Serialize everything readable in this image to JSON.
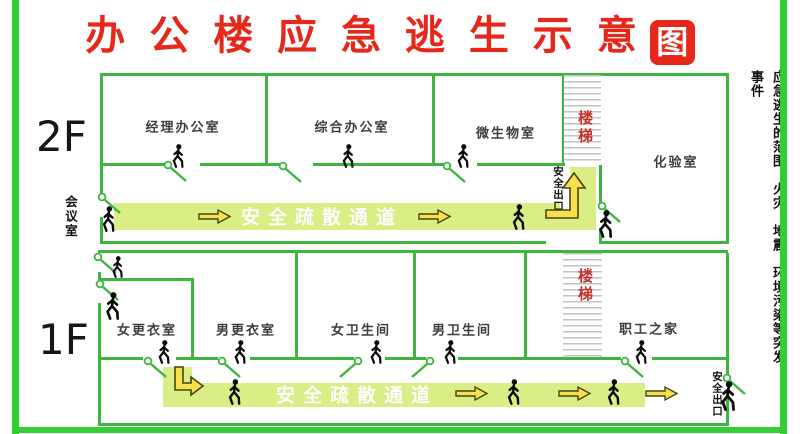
{
  "title": {
    "main": "办 公 楼 应 急 逃 生 示 意",
    "boxed": "图"
  },
  "side_note": "应急逃生的范围：火灾、地震、环境污染等突发事件",
  "floors": {
    "f2": "2F",
    "f1": "1F"
  },
  "labels": {
    "stairs": "楼梯",
    "corridor": "安全疏散通道",
    "exit": "安全出口",
    "meeting_room": "会议室"
  },
  "rooms_f2": [
    {
      "name": "经理办公室",
      "cx": 183,
      "cy": 126
    },
    {
      "name": "综合办公室",
      "cx": 352,
      "cy": 126
    },
    {
      "name": "微生物室",
      "cx": 506,
      "cy": 132
    },
    {
      "name": "化验室",
      "cx": 676,
      "cy": 161
    }
  ],
  "rooms_f1": [
    {
      "name": "女更衣室",
      "cx": 147,
      "cy": 329
    },
    {
      "name": "男更衣室",
      "cx": 246,
      "cy": 329
    },
    {
      "name": "女卫生间",
      "cx": 361,
      "cy": 329
    },
    {
      "name": "男卫生间",
      "cx": 462,
      "cy": 329
    },
    {
      "name": "职工之家",
      "cx": 649,
      "cy": 328
    }
  ],
  "colors": {
    "frame_green": "#35cd35",
    "wall_green": "#3eb53e",
    "band_green": "#d9ee85",
    "title_red": "#e6281b",
    "stairs_red": "#c5312a",
    "arrow_yellow": "#f7e04e",
    "hatch_gray": "#c3c3c3"
  },
  "geometry": {
    "canvas": {
      "w": 800,
      "h": 434
    },
    "frame": [
      [
        12,
        0,
        7,
        434
      ],
      [
        780,
        0,
        7,
        434
      ],
      [
        12,
        427,
        775,
        6
      ]
    ],
    "walls": [
      [
        100,
        73,
        629,
        3
      ],
      [
        100,
        73,
        3,
        125
      ],
      [
        100,
        217,
        3,
        27
      ],
      [
        100,
        241,
        446,
        3
      ],
      [
        599,
        241,
        130,
        3
      ],
      [
        726,
        73,
        3,
        171
      ],
      [
        100,
        163,
        66,
        3
      ],
      [
        200,
        163,
        80,
        3
      ],
      [
        313,
        163,
        120,
        3
      ],
      [
        432,
        163,
        14,
        3
      ],
      [
        477,
        163,
        87,
        3
      ],
      [
        265,
        73,
        3,
        93
      ],
      [
        432,
        73,
        3,
        93
      ],
      [
        562,
        73,
        3,
        93
      ],
      [
        599,
        165,
        3,
        43
      ],
      [
        599,
        228,
        3,
        16
      ],
      [
        98,
        250,
        630,
        3
      ],
      [
        98,
        272,
        3,
        8
      ],
      [
        98,
        303,
        3,
        123
      ],
      [
        98,
        278,
        96,
        3
      ],
      [
        191,
        278,
        3,
        82
      ],
      [
        295,
        253,
        3,
        107
      ],
      [
        413,
        253,
        3,
        107
      ],
      [
        524,
        253,
        3,
        107
      ],
      [
        98,
        357,
        45,
        3
      ],
      [
        176,
        357,
        42,
        3
      ],
      [
        250,
        357,
        104,
        3
      ],
      [
        385,
        357,
        41,
        3
      ],
      [
        458,
        357,
        163,
        3
      ],
      [
        652,
        357,
        76,
        3
      ],
      [
        726,
        253,
        3,
        122
      ],
      [
        726,
        398,
        3,
        28
      ],
      [
        98,
        423,
        631,
        3
      ]
    ],
    "hatches": [
      [
        564,
        75,
        37,
        88
      ],
      [
        563,
        253,
        39,
        104
      ]
    ],
    "bands": [
      [
        114,
        203,
        446,
        27
      ],
      [
        570,
        167,
        26,
        63
      ],
      [
        546,
        211,
        26,
        19
      ],
      [
        163,
        367,
        29,
        40
      ],
      [
        192,
        383,
        453,
        24
      ]
    ],
    "band_texts": [
      [
        322,
        216
      ],
      [
        357,
        394
      ]
    ],
    "doors": [
      [
        168,
        165,
        1
      ],
      [
        283,
        166,
        1
      ],
      [
        447,
        166,
        1
      ],
      [
        602,
        206,
        1
      ],
      [
        102,
        197,
        1
      ],
      [
        98,
        257,
        1
      ],
      [
        100,
        284,
        1
      ],
      [
        148,
        361,
        1
      ],
      [
        222,
        361,
        1
      ],
      [
        358,
        361,
        -1
      ],
      [
        430,
        361,
        -1
      ],
      [
        625,
        361,
        1
      ],
      [
        727,
        378,
        1
      ]
    ],
    "persons": [
      [
        170,
        144,
        24
      ],
      [
        340,
        144,
        24
      ],
      [
        455,
        144,
        24
      ],
      [
        100,
        206,
        26
      ],
      [
        510,
        204,
        26
      ],
      [
        596,
        210,
        28
      ],
      [
        110,
        256,
        22
      ],
      [
        103,
        292,
        28
      ],
      [
        156,
        340,
        24
      ],
      [
        232,
        340,
        24
      ],
      [
        368,
        340,
        24
      ],
      [
        442,
        340,
        24
      ],
      [
        633,
        340,
        24
      ],
      [
        226,
        379,
        26
      ],
      [
        505,
        379,
        26
      ],
      [
        605,
        379,
        26
      ],
      [
        718,
        381,
        30
      ]
    ],
    "arrows": [
      [
        198,
        209
      ],
      [
        418,
        209
      ],
      [
        455,
        386
      ],
      [
        558,
        386
      ],
      [
        645,
        386
      ]
    ],
    "l_arrow_up": [
      544,
      170
    ],
    "l_arrow_down": [
      172,
      366
    ],
    "stairs_labels": [
      [
        575,
        110
      ],
      [
        575,
        268
      ]
    ],
    "exit_labels": [
      [
        551,
        166
      ],
      [
        710,
        371
      ]
    ],
    "meeting_label": [
      61,
      195
    ],
    "floor_label_f2": [
      36,
      112
    ],
    "floor_label_f1": [
      38,
      315
    ],
    "side_note_pos": [
      744,
      70
    ]
  }
}
